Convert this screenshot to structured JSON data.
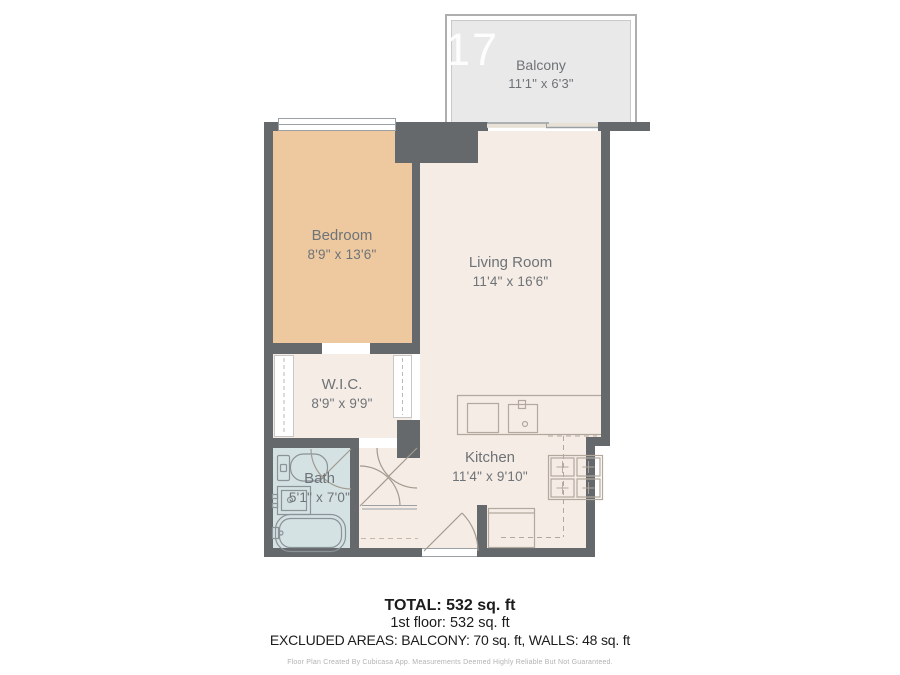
{
  "watermark": "317",
  "rooms": [
    {
      "name": "Balcony",
      "dims": "11'1\" x 6'3\""
    },
    {
      "name": "Bedroom",
      "dims": "8'9\" x 13'6\""
    },
    {
      "name": "Living Room",
      "dims": "11'4\" x 16'6\""
    },
    {
      "name": "W.I.C.",
      "dims": "8'9\" x 9'9\""
    },
    {
      "name": "Bath",
      "dims": "5'1\" x 7'0\""
    },
    {
      "name": "Kitchen",
      "dims": "11'4\" x 9'10\""
    }
  ],
  "summary": {
    "total": "TOTAL: 532 sq. ft",
    "floor": "1st floor: 532 sq. ft",
    "excluded": "EXCLUDED AREAS: BALCONY: 70 sq. ft, WALLS: 48 sq. ft",
    "disclaimer": "Floor Plan Created By Cubicasa App. Measurements Deemed Highly Reliable But Not Guaranteed."
  },
  "colors": {
    "wall": "#65696c",
    "bedroom_fill": "#eec9a0",
    "bath_fill": "#d4e2e4",
    "room_fill": "#f5ece5",
    "balcony_fill": "#e9e9e9",
    "label_text": "#6e7377"
  }
}
